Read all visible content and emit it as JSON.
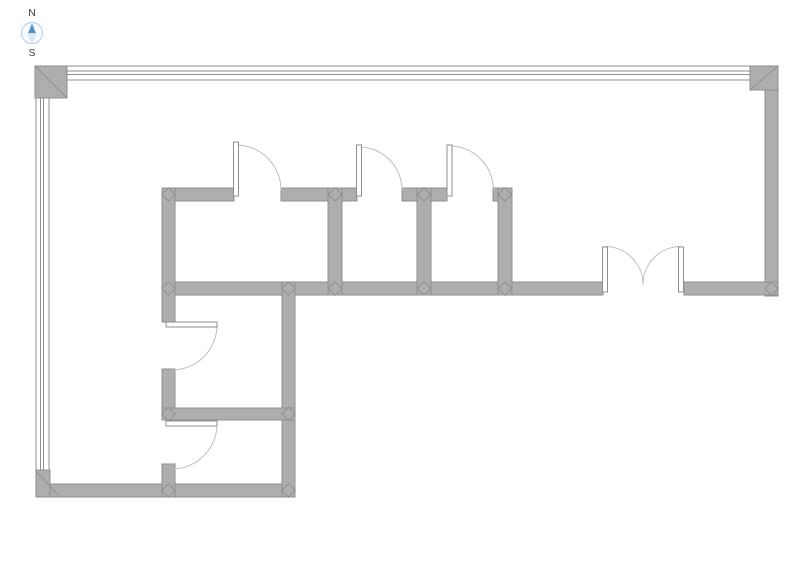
{
  "title": "floor-plan",
  "compass": {
    "north_label": "N",
    "south_label": "S",
    "icon": "compass-rose-icon"
  },
  "colors": {
    "wall-fill": "#aeaeae",
    "wall-edge": "#8f8f8f",
    "arc-color": "#bdbdbd",
    "door-fill": "#ffffff",
    "window-fill": "#ffffff",
    "bg": "#ffffff",
    "compass-north": "#4a90d2",
    "compass-south": "#dcebf6",
    "compass-ring": "#b9d5e9",
    "label-color": "#3c3c3c"
  }
}
